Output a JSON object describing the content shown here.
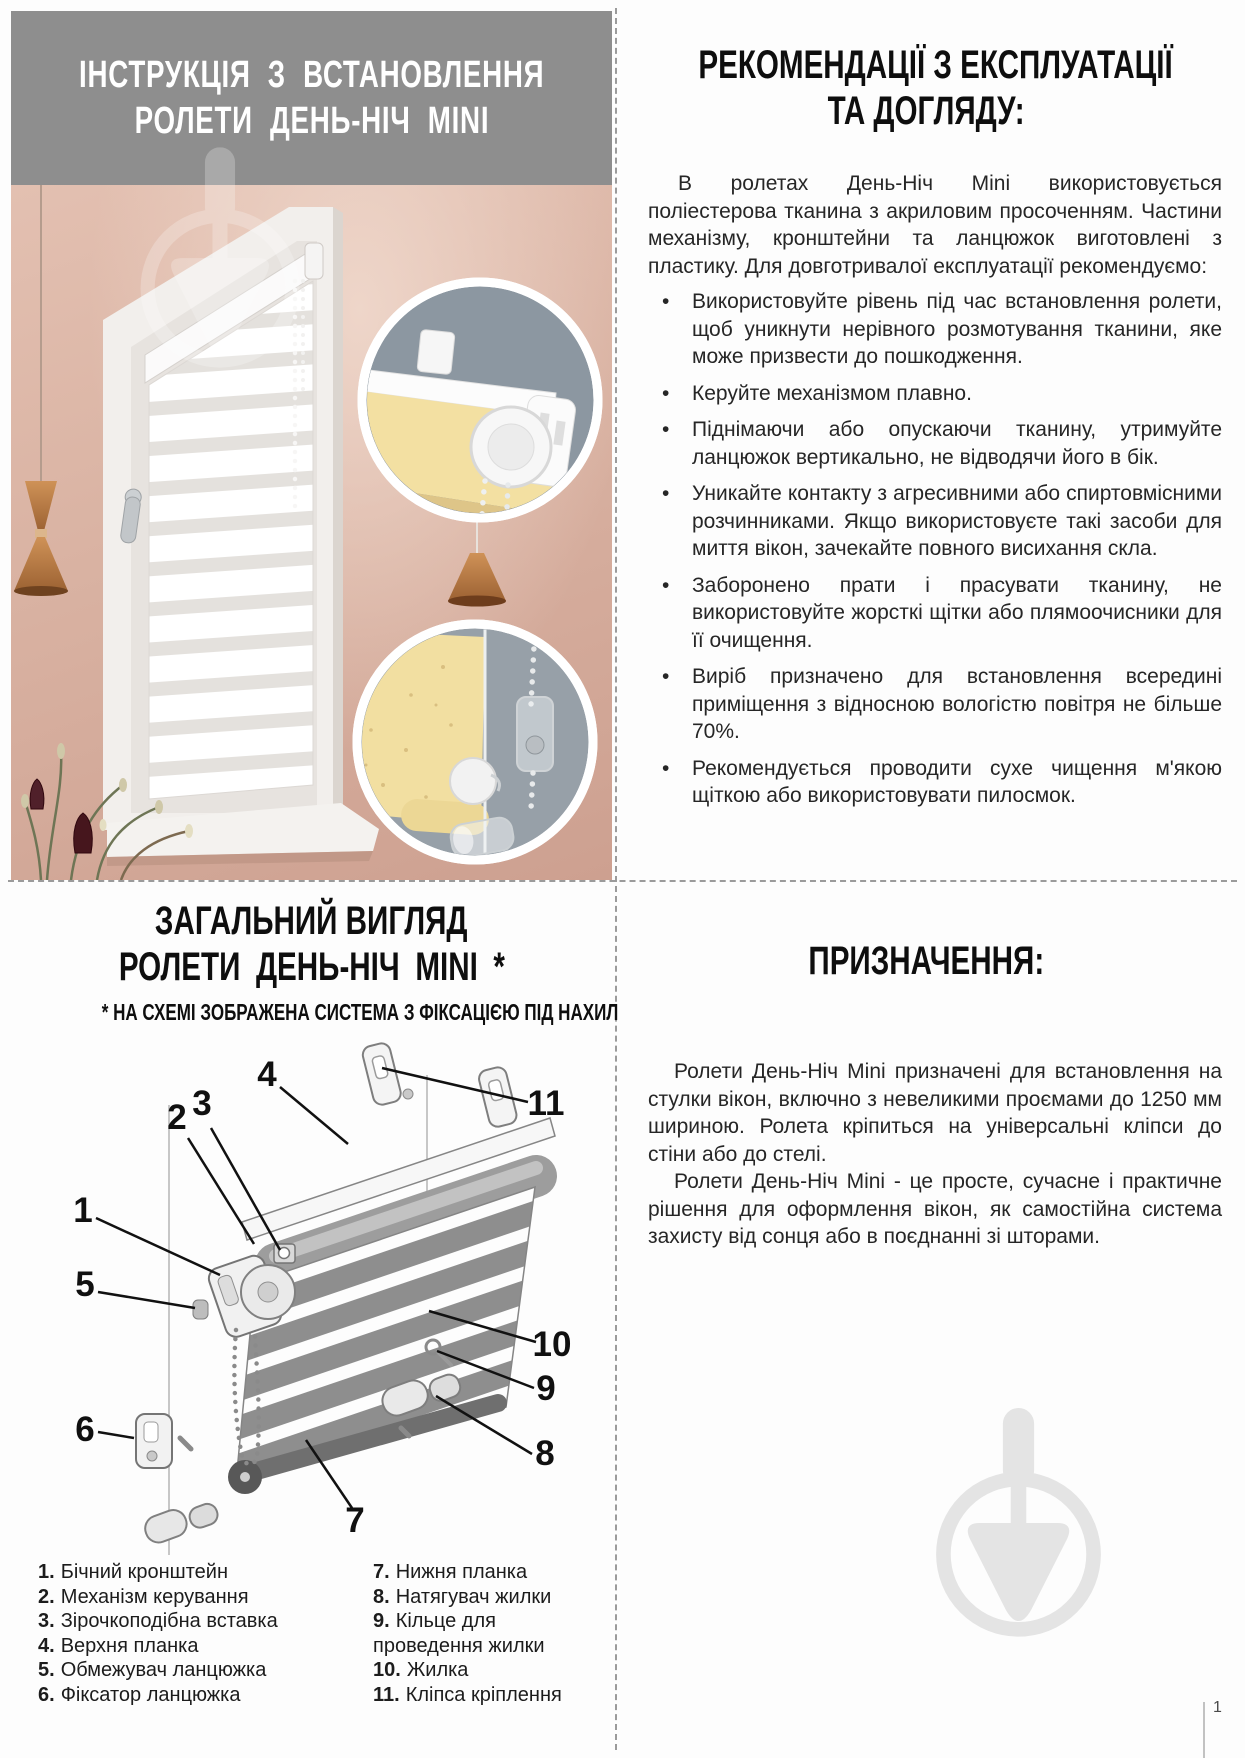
{
  "install_header": {
    "line1": "ІНСТРУКЦІЯ З ВСТАНОВЛЕННЯ",
    "line2": "РОЛЕТИ ДЕНЬ-НІЧ MINI"
  },
  "recommendations": {
    "title_line1": "РЕКОМЕНДАЦІЇ З ЕКСПЛУАТАЦІЇ",
    "title_line2": "ТА ДОГЛЯДУ:",
    "intro": "В ролетах День-Ніч Mini використовується поліестерова тканина з акриловим просоченням. Частини механізму, кронштейни та ланцюжок виготовлені з пластику. Для довготривалої експлуатації рекомендуємо:",
    "bullet_char": "•",
    "bullets": [
      "Використовуйте рівень під час встановлення ролети, щоб уникнути нерівного розмотування тканини, яке може призвести до пошкодження.",
      "Керуйте механізмом плавно.",
      "Піднімаючи або опускаючи тканину, утримуйте ланцюжок вертикально, не відводячи його в бік.",
      "Уникайте контакту з агресивними або спиртовмісними розчинниками. Якщо використовуєте такі засоби для миття вікон, зачекайте повного висихання скла.",
      "Заборонено прати і прасувати тканину, не використовуйте жорсткі щітки або плямоочисники для її очищення.",
      "Виріб призначено для встановлення всередині приміщення з відносною вологістю повітря не більше 70%.",
      "Рекомендується проводити сухе чищення м'якою щіткою або використовувати пилосмок."
    ]
  },
  "overview": {
    "title_line1": "ЗАГАЛЬНИЙ ВИГЛЯД",
    "title_line2": "РОЛЕТИ ДЕНЬ-НІЧ MINI *",
    "subtitle": "* НА СХЕМІ ЗОБРАЖЕНА СИСТЕМА З ФІКСАЦІЄЮ ПІД НАХИЛ",
    "callouts": [
      "1",
      "2",
      "3",
      "4",
      "5",
      "6",
      "7",
      "8",
      "9",
      "10",
      "11"
    ],
    "legend_left": [
      {
        "n": "1.",
        "t": "Бічний кронштейн"
      },
      {
        "n": "2.",
        "t": "Механізм керування"
      },
      {
        "n": "3.",
        "t": "Зірочкоподібна вставка"
      },
      {
        "n": "4.",
        "t": "Верхня планка"
      },
      {
        "n": "5.",
        "t": "Обмежувач ланцюжка"
      },
      {
        "n": "6.",
        "t": "Фіксатор ланцюжка"
      }
    ],
    "legend_right": [
      {
        "n": "7.",
        "t": "Нижня планка"
      },
      {
        "n": "8.",
        "t": "Натягувач жилки"
      },
      {
        "n": "9.",
        "t": "Кільце для проведення жилки"
      },
      {
        "n": "10.",
        "t": "Жилка"
      },
      {
        "n": "11.",
        "t": "Кліпса кріплення"
      }
    ]
  },
  "purpose": {
    "title": "ПРИЗНАЧЕННЯ:",
    "p1": "Ролети День-Ніч Mini призначені для встановлення на стулки вікон, включно з невеликими проємами до 1250 мм шириною. Ролета кріпиться на універсальні кліпси до стіни або до стелі.",
    "p2": "Ролети День-Ніч Mini - це просте, сучасне і практичне рішення для оформлення вікон, як самостійна система захисту від сонця або в поєднанні зі шторами."
  },
  "footer": {
    "page_number": "1"
  },
  "colors": {
    "header_gray": "#8e8e8e",
    "wall_pink": "#d9b2a2",
    "inset_bg": "#8c97a1",
    "blind_yellow": "#f2dfa2",
    "copper": "#c0804c",
    "watermark_gray": "#e4e4e4"
  }
}
